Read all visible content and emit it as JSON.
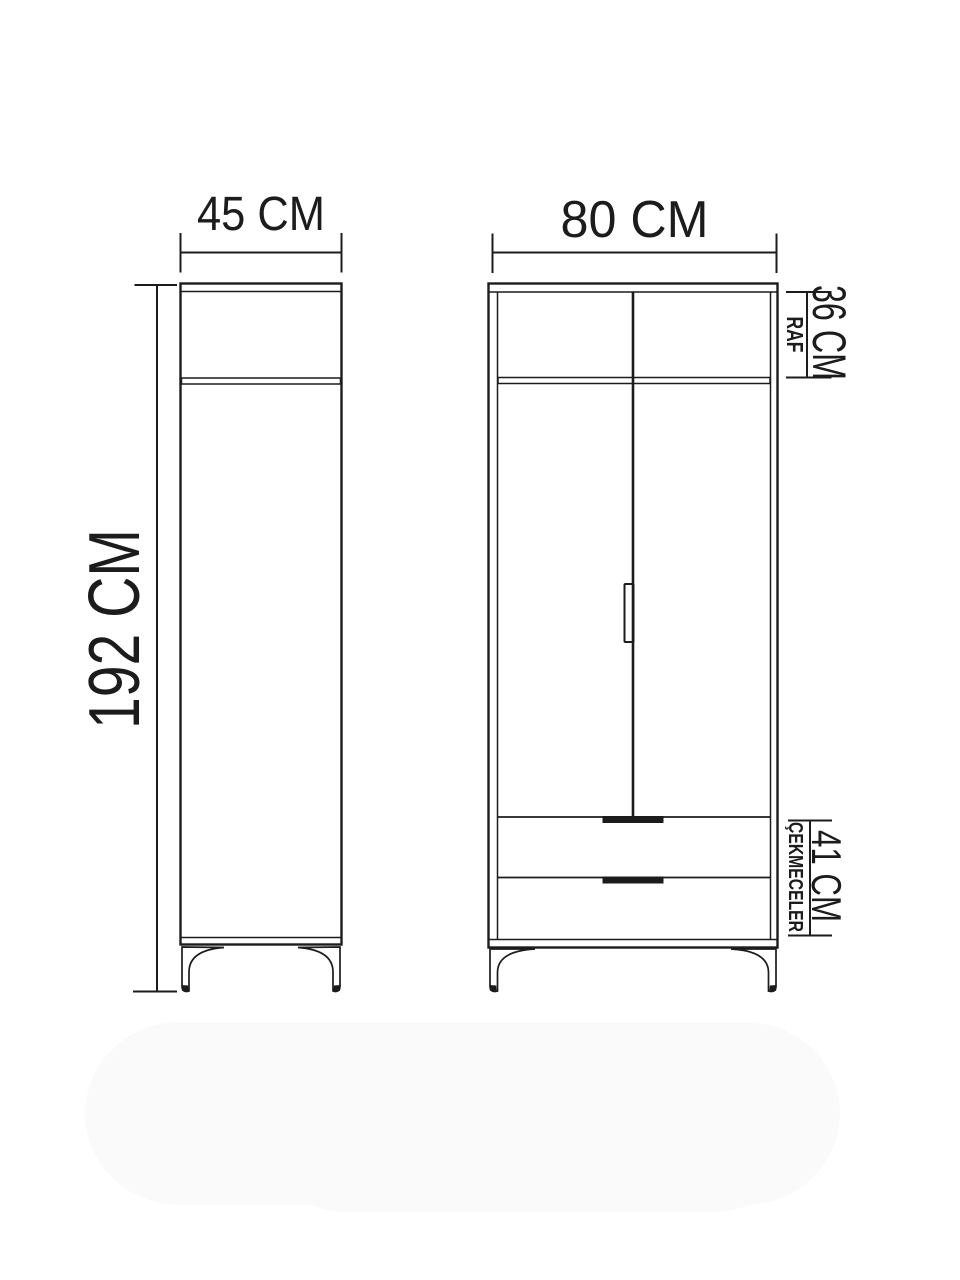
{
  "dimensions": {
    "side_width": "45 CM",
    "front_width": "80 CM",
    "height": "192 CM",
    "shelf_size": "36 CM",
    "shelf_label": "RAF",
    "drawers_size": "41 CM",
    "drawers_label": "ÇEKMECELER"
  },
  "colors": {
    "line": "#1c1c1c",
    "background": "#ffffff",
    "shadow": "#fafafa"
  }
}
